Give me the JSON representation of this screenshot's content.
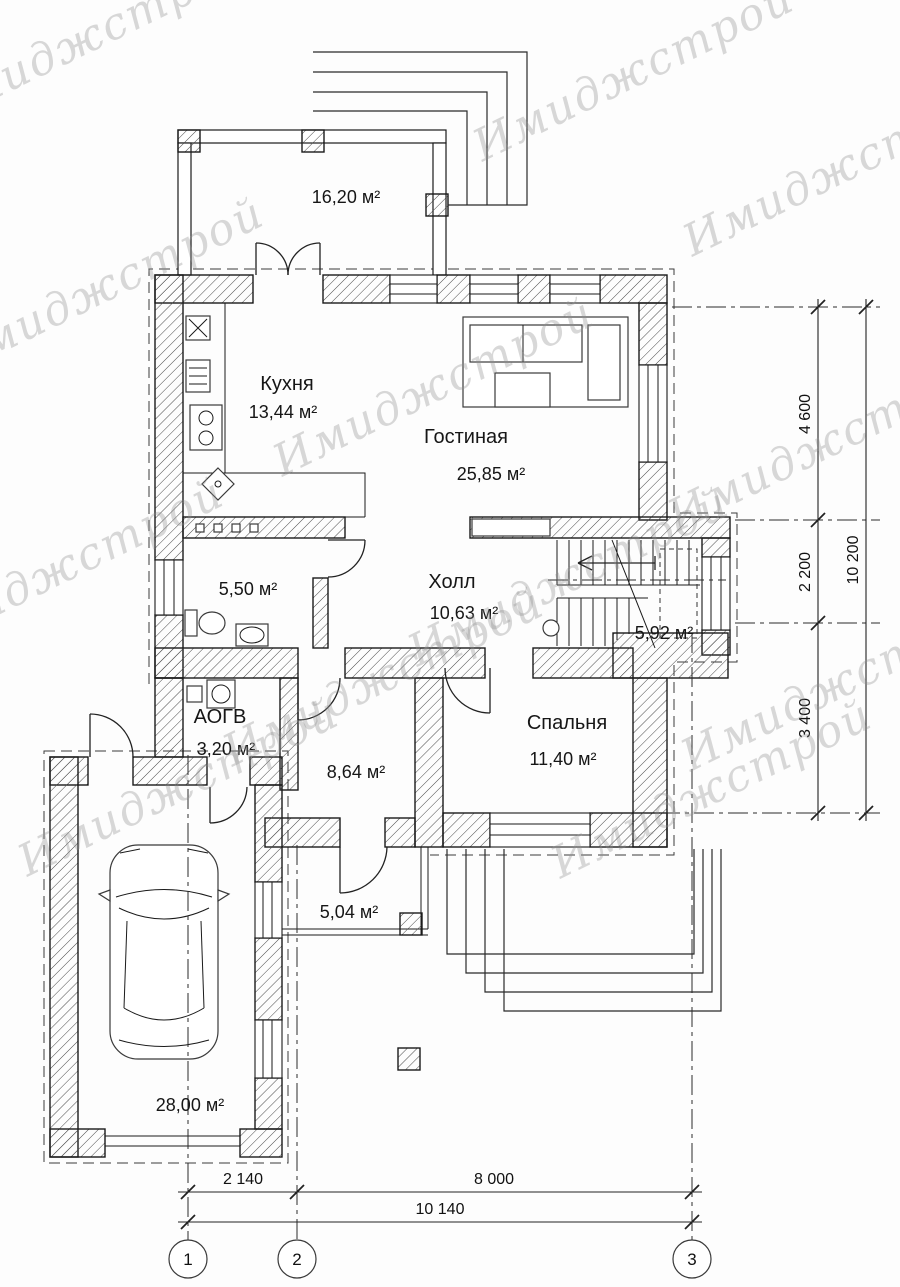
{
  "watermark": {
    "text": "Имиджстрой"
  },
  "rooms": {
    "terrace": {
      "area": "16,20 м²"
    },
    "kitchen": {
      "name": "Кухня",
      "area": "13,44 м²"
    },
    "living": {
      "name": "Гостиная",
      "area": "25,85 м²"
    },
    "hall": {
      "name": "Холл",
      "area": "10,63 м²"
    },
    "bath": {
      "area": "5,50 м²"
    },
    "stairs": {
      "area": "5,92 м²"
    },
    "boiler": {
      "name": "АОГВ",
      "area": "3,20 м²"
    },
    "room864": {
      "area": "8,64 м²"
    },
    "bedroom": {
      "name": "Спальня",
      "area": "11,40 м²"
    },
    "porch": {
      "area": "5,04 м²"
    },
    "garage": {
      "area": "28,00 м²"
    }
  },
  "dimensions": {
    "bottom": {
      "d1": "2 140",
      "d2": "8 000",
      "total": "10 140"
    },
    "right": {
      "d1": "4 600",
      "d2": "2 200",
      "d3": "3 400",
      "total": "10 200"
    }
  },
  "grid": {
    "axes": [
      "1",
      "2",
      "3"
    ]
  }
}
